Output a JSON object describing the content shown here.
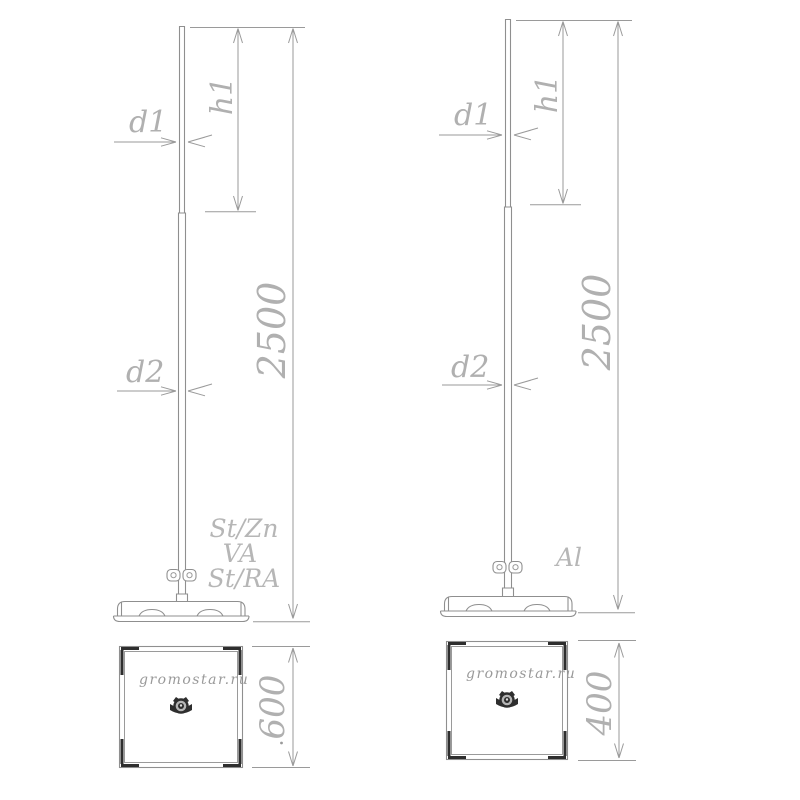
{
  "drawing": {
    "type": "technical-diagram",
    "subject": "lightning rod mast with base plate, elevation and plan views, two variants",
    "colors": {
      "background": "#ffffff",
      "line": "#8f8f8f",
      "dark_detail": "#2e2e2e",
      "dimension_text": "#b0b0b0",
      "watermark_text": "#9a9a9a"
    },
    "left": {
      "dims": {
        "tip_diameter": "d1",
        "tip_height": "h1",
        "total_height": "2500",
        "tube_diameter": "d2",
        "base_size": "600"
      },
      "materials": [
        "St/Zn",
        "VA",
        "St/RA"
      ],
      "watermark": "gromostar.ru"
    },
    "right": {
      "dims": {
        "tip_diameter": "d1",
        "tip_height": "h1",
        "total_height": "2500",
        "tube_diameter": "d2",
        "base_size": "400"
      },
      "materials": [
        "Al"
      ],
      "watermark": "gromostar.ru"
    }
  }
}
